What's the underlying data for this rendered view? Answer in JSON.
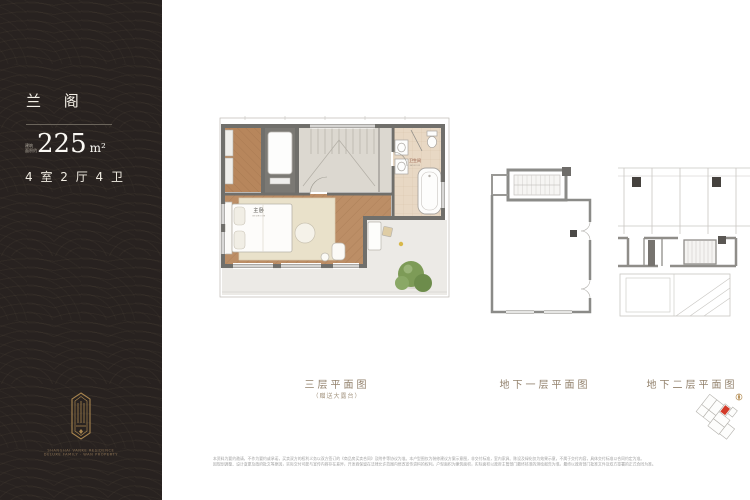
{
  "colors": {
    "sidebar_bg": "#282220",
    "accent_gold": "#a8854f",
    "caption_brown": "#92816c",
    "highlight_red": "#d23b2a",
    "wood_floor": "#bc8e66",
    "wall_gray": "#706f6b",
    "tree_green": "#7d9b57"
  },
  "sidebar": {
    "title": "兰 阁",
    "area_label_line1": "建筑",
    "area_label_line2": "面积约",
    "area_value": "225",
    "area_unit": "m²",
    "layout_text": "4 室 2 厅 4 卫",
    "brand_line1": "SHANGHAI VANKE RESIDENCE",
    "brand_line2": "DELUXE FAMILY · WAN PROPERTY"
  },
  "plans": {
    "level3": {
      "caption": "三层平面图",
      "subcaption": "（赠送大露台）",
      "labels": {
        "bedroom_cn": "主卧",
        "bedroom_en": "BEDROOM",
        "bathroom_cn": "卫生间",
        "bathroom_en": "BATHROOM"
      }
    },
    "basement1": {
      "caption": "地下一层平面图"
    },
    "basement2": {
      "caption": "地下二层平面图"
    }
  },
  "disclaimer": {
    "line1": "本资料为要约邀请，不作为要约或承诺，买卖双方的权利义务以双方签订的《商品房买卖合同》及附件等协议为准。本户型图仅为装修建议方案示意图，非交付标准，室内家具、陈设及绿化仅为效果示意，不属于交付内容，具体交付标准以合同约定为准。",
    "line2": "因规划调整、设计变更及政府批文等原因，实际交付可能与宣传内容存在差异，开发商保留在法律允许范围内修改宣传资料的权利。户型面积为建筑面积，实际面积以政府主管部门最终核准的测绘报告为准。最终以政府部门批准文件及双方签署的正式合同为准。"
  }
}
